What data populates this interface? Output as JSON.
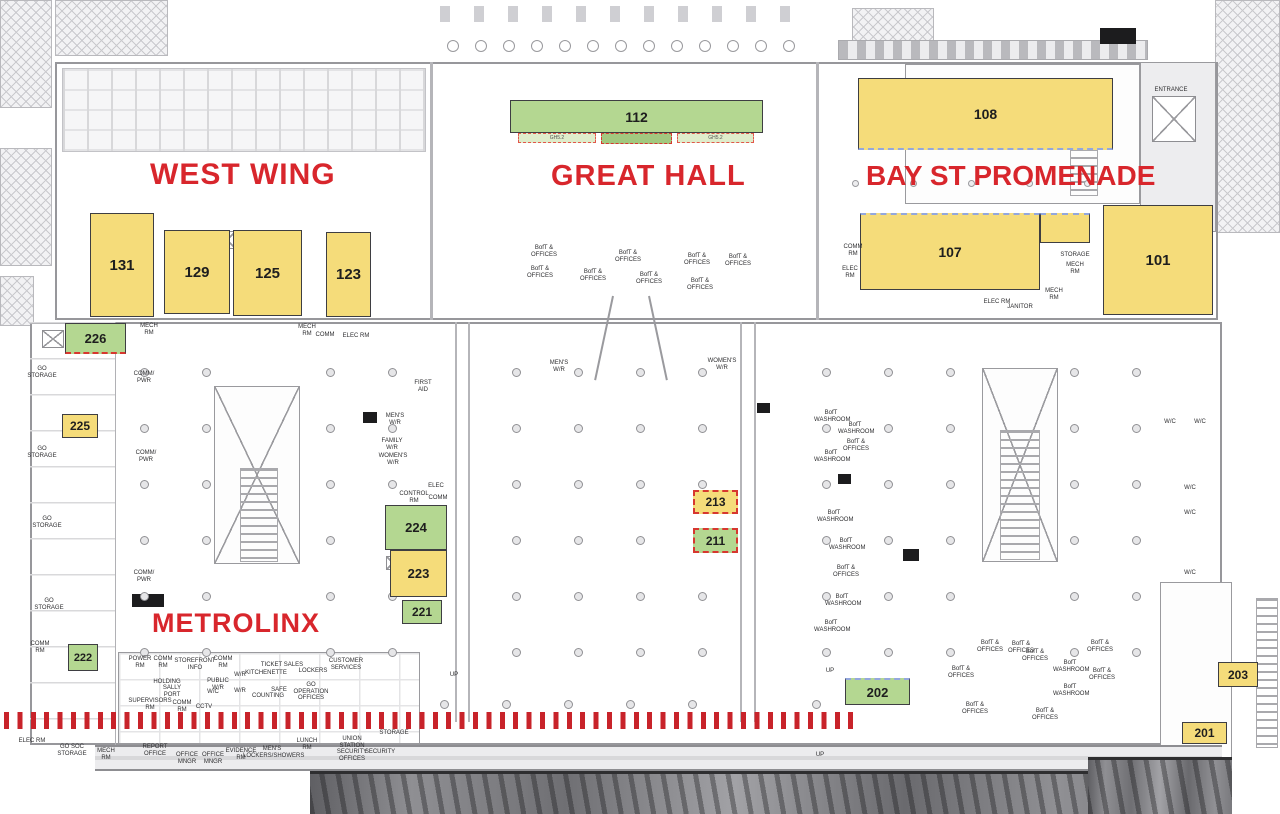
{
  "colors": {
    "room_yellow": "#F5DC7A",
    "room_green": "#B4D791",
    "zone_light_green": "#DFECCB",
    "zone_dark_green": "#A2C87F",
    "title_red": "#D8262C",
    "tick_red": "#C8232A",
    "dash_red": "#D7372F",
    "dash_blue": "#93A7DE"
  },
  "area_titles": [
    {
      "id": "west-wing",
      "label": "WEST WING",
      "x": 150,
      "y": 158,
      "fs": 30,
      "ls": 1
    },
    {
      "id": "great-hall",
      "label": "GREAT HALL",
      "x": 551,
      "y": 160,
      "fs": 29,
      "ls": 1
    },
    {
      "id": "bay-st-promenade",
      "label": "BAY ST PROMENADE",
      "x": 866,
      "y": 160,
      "fs": 28,
      "ls": 0
    },
    {
      "id": "metrolinx",
      "label": "METROLINX",
      "x": 152,
      "y": 608,
      "fs": 27,
      "ls": 1
    }
  ],
  "rooms": [
    {
      "number": "131",
      "fill": "yellow",
      "x": 90,
      "y": 213,
      "w": 64,
      "h": 104,
      "fs": 15,
      "dash": ""
    },
    {
      "number": "129",
      "fill": "yellow",
      "x": 164,
      "y": 230,
      "w": 66,
      "h": 84,
      "fs": 15,
      "dash": ""
    },
    {
      "number": "125",
      "fill": "yellow",
      "x": 233,
      "y": 230,
      "w": 69,
      "h": 86,
      "fs": 15,
      "dash": ""
    },
    {
      "number": "123",
      "fill": "yellow",
      "x": 326,
      "y": 232,
      "w": 45,
      "h": 85,
      "fs": 15,
      "dash": ""
    },
    {
      "number": "112",
      "fill": "green",
      "x": 510,
      "y": 100,
      "w": 253,
      "h": 33,
      "fs": 14,
      "dash": ""
    },
    {
      "number": "108",
      "fill": "yellow",
      "x": 858,
      "y": 78,
      "w": 255,
      "h": 72,
      "fs": 14,
      "dash": "blue-bottom"
    },
    {
      "number": "107",
      "fill": "yellow",
      "x": 860,
      "y": 213,
      "w": 180,
      "h": 77,
      "fs": 14,
      "dash": "blue-top"
    },
    {
      "number": "",
      "fill": "yellow",
      "x": 1040,
      "y": 213,
      "w": 50,
      "h": 30,
      "fs": 10,
      "dash": "blue-top"
    },
    {
      "number": "101",
      "fill": "yellow",
      "x": 1103,
      "y": 205,
      "w": 110,
      "h": 110,
      "fs": 15,
      "dash": ""
    },
    {
      "number": "226",
      "fill": "green",
      "x": 65,
      "y": 323,
      "w": 61,
      "h": 31,
      "fs": 13,
      "dash": "red-bottom"
    },
    {
      "number": "225",
      "fill": "yellow",
      "x": 62,
      "y": 414,
      "w": 36,
      "h": 24,
      "fs": 12,
      "dash": ""
    },
    {
      "number": "224",
      "fill": "green",
      "x": 385,
      "y": 505,
      "w": 62,
      "h": 45,
      "fs": 13,
      "dash": ""
    },
    {
      "number": "223",
      "fill": "yellow",
      "x": 390,
      "y": 550,
      "w": 57,
      "h": 47,
      "fs": 13,
      "dash": ""
    },
    {
      "number": "221",
      "fill": "green",
      "x": 402,
      "y": 600,
      "w": 40,
      "h": 24,
      "fs": 12,
      "dash": ""
    },
    {
      "number": "222",
      "fill": "green",
      "x": 68,
      "y": 644,
      "w": 30,
      "h": 27,
      "fs": 11,
      "dash": ""
    },
    {
      "number": "213",
      "fill": "yellow",
      "x": 693,
      "y": 490,
      "w": 45,
      "h": 24,
      "fs": 12,
      "dash": "red"
    },
    {
      "number": "211",
      "fill": "green",
      "x": 693,
      "y": 528,
      "w": 45,
      "h": 25,
      "fs": 12,
      "dash": "red"
    },
    {
      "number": "202",
      "fill": "green",
      "x": 845,
      "y": 678,
      "w": 65,
      "h": 27,
      "fs": 13,
      "dash": "blue-top"
    },
    {
      "number": "203",
      "fill": "yellow",
      "x": 1218,
      "y": 662,
      "w": 40,
      "h": 25,
      "fs": 12,
      "dash": ""
    },
    {
      "number": "201",
      "fill": "yellow",
      "x": 1182,
      "y": 722,
      "w": 45,
      "h": 22,
      "fs": 12,
      "dash": ""
    }
  ],
  "zones": [
    {
      "label": "GH5.2",
      "x": 518,
      "y": 133,
      "w": 78,
      "h": 10,
      "type": "light"
    },
    {
      "label": "",
      "x": 601,
      "y": 133,
      "w": 71,
      "h": 11,
      "type": "dark"
    },
    {
      "label": "GH5.2",
      "x": 677,
      "y": 133,
      "w": 77,
      "h": 10,
      "type": "light"
    }
  ],
  "small_labels": [
    {
      "t": "MECH\nRM",
      "x": 136,
      "y": 323,
      "w": 26
    },
    {
      "t": "MECH\nRM",
      "x": 294,
      "y": 324,
      "w": 26
    },
    {
      "t": "COMM",
      "x": 313,
      "y": 332,
      "w": 24
    },
    {
      "t": "ELEC RM",
      "x": 342,
      "y": 333,
      "w": 28
    },
    {
      "t": "GO\nSTORAGE",
      "x": 26,
      "y": 366,
      "w": 32
    },
    {
      "t": "GO\nSTORAGE",
      "x": 26,
      "y": 446,
      "w": 32
    },
    {
      "t": "GO\nSTORAGE",
      "x": 31,
      "y": 516,
      "w": 32
    },
    {
      "t": "GO\nSTORAGE",
      "x": 33,
      "y": 598,
      "w": 32
    },
    {
      "t": "COMM\nRM",
      "x": 26,
      "y": 641,
      "w": 28
    },
    {
      "t": "COMM/\nPWR",
      "x": 130,
      "y": 371,
      "w": 28
    },
    {
      "t": "COMM/\nPWR",
      "x": 132,
      "y": 450,
      "w": 28
    },
    {
      "t": "COMM/\nPWR",
      "x": 130,
      "y": 570,
      "w": 28
    },
    {
      "t": "FIRST\nAID",
      "x": 410,
      "y": 380,
      "w": 26
    },
    {
      "t": "MEN'S\nW/R",
      "x": 382,
      "y": 413,
      "w": 26
    },
    {
      "t": "FAMILY\nW/R",
      "x": 379,
      "y": 438,
      "w": 26
    },
    {
      "t": "WOMEN'S\nW/R",
      "x": 378,
      "y": 453,
      "w": 30
    },
    {
      "t": "ELEC",
      "x": 426,
      "y": 483,
      "w": 20
    },
    {
      "t": "CONTROL\nRM",
      "x": 398,
      "y": 491,
      "w": 32
    },
    {
      "t": "COMM",
      "x": 426,
      "y": 495,
      "w": 24
    },
    {
      "t": "MEN'S\nW/R",
      "x": 546,
      "y": 360,
      "w": 26
    },
    {
      "t": "WOMEN'S\nW/R",
      "x": 706,
      "y": 358,
      "w": 32
    },
    {
      "t": "ENTRANCE",
      "x": 1148,
      "y": 87,
      "w": 46
    },
    {
      "t": "STORAGE",
      "x": 1058,
      "y": 252,
      "w": 34
    },
    {
      "t": "MECH\nRM",
      "x": 1062,
      "y": 262,
      "w": 26
    },
    {
      "t": "MECH\nRM",
      "x": 1041,
      "y": 288,
      "w": 26
    },
    {
      "t": "ELEC RM",
      "x": 983,
      "y": 299,
      "w": 28
    },
    {
      "t": "JANITOR",
      "x": 1006,
      "y": 304,
      "w": 28
    },
    {
      "t": "COMM\nRM",
      "x": 841,
      "y": 244,
      "w": 24
    },
    {
      "t": "ELEC RM",
      "x": 837,
      "y": 266,
      "w": 26
    },
    {
      "t": "BofT &\nOFFICES",
      "x": 530,
      "y": 245,
      "w": 28
    },
    {
      "t": "BofT &\nOFFICES",
      "x": 526,
      "y": 266,
      "w": 28
    },
    {
      "t": "BofT &\nOFFICES",
      "x": 579,
      "y": 269,
      "w": 28
    },
    {
      "t": "BofT &\nOFFICES",
      "x": 614,
      "y": 250,
      "w": 28
    },
    {
      "t": "BofT &\nOFFICES",
      "x": 683,
      "y": 253,
      "w": 28
    },
    {
      "t": "BofT &\nOFFICES",
      "x": 724,
      "y": 254,
      "w": 28
    },
    {
      "t": "BofT &\nOFFICES",
      "x": 686,
      "y": 278,
      "w": 28
    },
    {
      "t": "BofT &\nOFFICES",
      "x": 635,
      "y": 272,
      "w": 28
    },
    {
      "t": "BofT\nWASHROOM",
      "x": 814,
      "y": 410,
      "w": 34
    },
    {
      "t": "BofT\nWASHROOM",
      "x": 838,
      "y": 422,
      "w": 34
    },
    {
      "t": "BofT &\nOFFICES",
      "x": 842,
      "y": 439,
      "w": 28
    },
    {
      "t": "BofT\nWASHROOM",
      "x": 814,
      "y": 450,
      "w": 34
    },
    {
      "t": "BofT\nWASHROOM",
      "x": 817,
      "y": 510,
      "w": 34
    },
    {
      "t": "BofT\nWASHROOM",
      "x": 829,
      "y": 538,
      "w": 34
    },
    {
      "t": "BofT &\nOFFICES",
      "x": 832,
      "y": 565,
      "w": 28
    },
    {
      "t": "BofT\nWASHROOM",
      "x": 825,
      "y": 594,
      "w": 34
    },
    {
      "t": "BofT\nWASHROOM",
      "x": 814,
      "y": 620,
      "w": 34
    },
    {
      "t": "BofT &\nOFFICES",
      "x": 975,
      "y": 640,
      "w": 30
    },
    {
      "t": "BofT &\nOFFICES",
      "x": 946,
      "y": 666,
      "w": 30
    },
    {
      "t": "BofT &\nOFFICES",
      "x": 1008,
      "y": 641,
      "w": 26
    },
    {
      "t": "BofT &\nOFFICES",
      "x": 1022,
      "y": 649,
      "w": 26
    },
    {
      "t": "BofT &\nOFFICES",
      "x": 1085,
      "y": 640,
      "w": 30
    },
    {
      "t": "BofT\nWASHROOM",
      "x": 1053,
      "y": 660,
      "w": 34
    },
    {
      "t": "BofT &\nOFFICES",
      "x": 1088,
      "y": 668,
      "w": 28
    },
    {
      "t": "BofT\nWASHROOM",
      "x": 1053,
      "y": 684,
      "w": 34
    },
    {
      "t": "BofT &\nOFFICES",
      "x": 960,
      "y": 702,
      "w": 30
    },
    {
      "t": "BofT &\nOFFICES",
      "x": 1030,
      "y": 708,
      "w": 30
    },
    {
      "t": "POWER\nRM",
      "x": 127,
      "y": 656,
      "w": 26
    },
    {
      "t": "COMM\nRM",
      "x": 151,
      "y": 656,
      "w": 24
    },
    {
      "t": "STOREFRONT\nINFO",
      "x": 172,
      "y": 658,
      "w": 46
    },
    {
      "t": "COMM\nRM",
      "x": 210,
      "y": 656,
      "w": 26
    },
    {
      "t": "TICKET SALES",
      "x": 258,
      "y": 662,
      "w": 48
    },
    {
      "t": "KITCHENETTE",
      "x": 245,
      "y": 670,
      "w": 42
    },
    {
      "t": "LOCKERS",
      "x": 297,
      "y": 668,
      "w": 32
    },
    {
      "t": "CUSTOMER\nSERVICES",
      "x": 327,
      "y": 658,
      "w": 38
    },
    {
      "t": "W/R",
      "x": 232,
      "y": 672,
      "w": 16
    },
    {
      "t": "W/R",
      "x": 232,
      "y": 688,
      "w": 16
    },
    {
      "t": "COUNTING",
      "x": 251,
      "y": 693,
      "w": 34
    },
    {
      "t": "SAFE",
      "x": 270,
      "y": 687,
      "w": 18
    },
    {
      "t": "GO\nOPERATION\nOFFICES",
      "x": 291,
      "y": 682,
      "w": 40
    },
    {
      "t": "HOLDING",
      "x": 152,
      "y": 679,
      "w": 30
    },
    {
      "t": "SALLY\nPORT",
      "x": 161,
      "y": 685,
      "w": 22
    },
    {
      "t": "SUPERVISORS\nRM",
      "x": 127,
      "y": 698,
      "w": 46
    },
    {
      "t": "COMM\nRM",
      "x": 170,
      "y": 700,
      "w": 24
    },
    {
      "t": "CCTV",
      "x": 194,
      "y": 704,
      "w": 20
    },
    {
      "t": "PUBLIC\nW/R",
      "x": 206,
      "y": 678,
      "w": 24
    },
    {
      "t": "W/C",
      "x": 205,
      "y": 689,
      "w": 16
    },
    {
      "t": "ELEC RM",
      "x": 18,
      "y": 738,
      "w": 28
    },
    {
      "t": "GO SOC\nSTORAGE",
      "x": 55,
      "y": 744,
      "w": 34
    },
    {
      "t": "MECH\nRM",
      "x": 94,
      "y": 748,
      "w": 24
    },
    {
      "t": "REPORT\nOFFICE",
      "x": 139,
      "y": 744,
      "w": 32
    },
    {
      "t": "OFFICE\nMNGR",
      "x": 174,
      "y": 752,
      "w": 26
    },
    {
      "t": "OFFICE\nMNGR",
      "x": 200,
      "y": 752,
      "w": 26
    },
    {
      "t": "EVIDENCE\nRM",
      "x": 224,
      "y": 748,
      "w": 34
    },
    {
      "t": "MEN'S\nLOCKERS/SHOWERS",
      "x": 243,
      "y": 746,
      "w": 58
    },
    {
      "t": "LUNCH\nRM",
      "x": 294,
      "y": 738,
      "w": 26
    },
    {
      "t": "UNION\nSTATION\nSECURITY\nOFFICES",
      "x": 335,
      "y": 736,
      "w": 34
    },
    {
      "t": "SECURITY",
      "x": 364,
      "y": 749,
      "w": 32
    },
    {
      "t": "STORAGE",
      "x": 379,
      "y": 730,
      "w": 30
    },
    {
      "t": "UP",
      "x": 448,
      "y": 672,
      "w": 12
    },
    {
      "t": "UP",
      "x": 824,
      "y": 668,
      "w": 12
    },
    {
      "t": "UP",
      "x": 814,
      "y": 752,
      "w": 12
    },
    {
      "t": "W/C",
      "x": 1162,
      "y": 419,
      "w": 16
    },
    {
      "t": "W/C",
      "x": 1192,
      "y": 419,
      "w": 16
    },
    {
      "t": "W/C",
      "x": 1182,
      "y": 485,
      "w": 16
    },
    {
      "t": "W/C",
      "x": 1182,
      "y": 510,
      "w": 16
    },
    {
      "t": "W/C",
      "x": 1182,
      "y": 570,
      "w": 16
    }
  ]
}
